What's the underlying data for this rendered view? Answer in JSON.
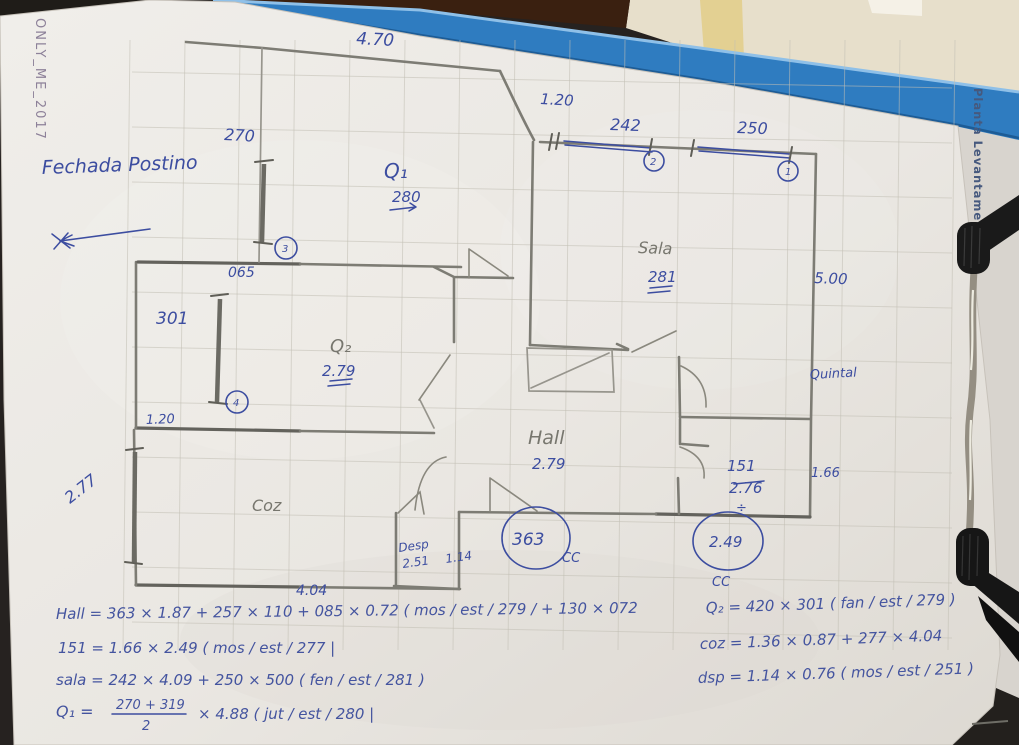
{
  "photo": {
    "watermark": "ONLY_ME_2017",
    "clipboard_side_label": "Planta Levantamento"
  },
  "notes": {
    "facade": "Fechada Postino"
  },
  "plan": {
    "rooms": {
      "q1": {
        "label": "Q₁",
        "height": "280"
      },
      "q2": {
        "label": "Q₂",
        "height": "2.79"
      },
      "sala": {
        "label": "Sala",
        "height": "281"
      },
      "hall": {
        "label": "Hall",
        "height": "2.79"
      },
      "coz": {
        "label": "Coz"
      },
      "desp": {
        "label": "Desp",
        "height": "2.51",
        "width": "1.14"
      },
      "wc": {
        "label": "151",
        "height": "2.76",
        "divide": "÷",
        "width": "1.66"
      },
      "quintal": {
        "label": "Quintal",
        "width": "5.00"
      }
    },
    "dims": {
      "top_width": "4.70",
      "top_recess": "1.20",
      "window_sala_a": "242",
      "window_sala_b": "250",
      "window_q1": "270",
      "recess_left": "065",
      "window_q2": "301",
      "left_recess": "1.20",
      "window_coz": "2.77",
      "coz_width": "4.04"
    },
    "window_numbers": [
      "1",
      "2",
      "3",
      "4"
    ],
    "circled_values": {
      "hall": "363",
      "wc": "2.49",
      "mark": "CC"
    }
  },
  "formulas": {
    "left": [
      "Hall = 363 × 1.87 + 257 × 110 + 085 × 0.72 ( mos / est / 279 / + 130 × 072",
      "151 = 1.66 × 2.49 ( mos / est / 277 |",
      "sala = 242 × 4.09 + 250 × 500 ( fen / est / 281 )",
      "Q₁ ="
    ],
    "q1_fraction": {
      "num": "270 + 319",
      "den": "2",
      "tail": "×  4.88  ( jut / est / 280 |"
    },
    "right": [
      "Q₂ = 420 × 301 ( fan / est / 279 )",
      "coz = 1.36 × 0.87 + 277 × 4.04",
      "dsp = 1.14 × 0.76 ( mos / est / 251 )"
    ]
  }
}
